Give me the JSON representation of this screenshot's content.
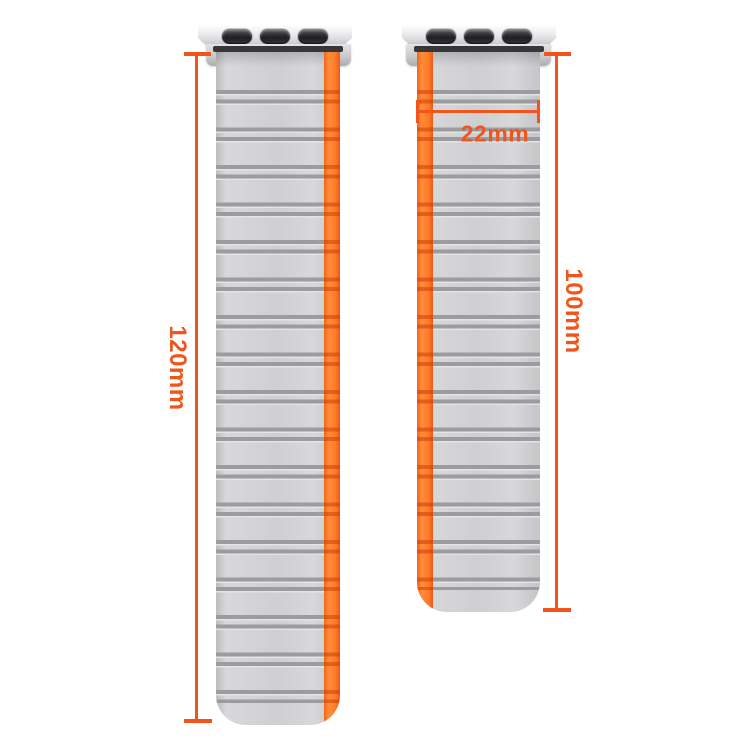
{
  "annotations": {
    "left_strap_length": "120mm",
    "right_strap_length": "100mm",
    "strap_width": "22mm",
    "annotation_color": "#F1551C"
  },
  "product": {
    "left_strap": {
      "length_label": "120mm",
      "stripe_side": "right",
      "adapter_slot_count": 3
    },
    "right_strap": {
      "length_label": "100mm",
      "width_label": "22mm",
      "stripe_side": "left",
      "adapter_slot_count": 3
    },
    "colors": {
      "strap_body": "#D2D2D4",
      "ridge_line": "#9B9CA0",
      "accent_stripe": "#FF7D2B",
      "stripe_crossing": "#CD3E06",
      "adapter_metal": "#D5D5D7",
      "adapter_slot": "#202024",
      "insert_bar": "#37373A",
      "background": "#FFFFFF"
    }
  }
}
